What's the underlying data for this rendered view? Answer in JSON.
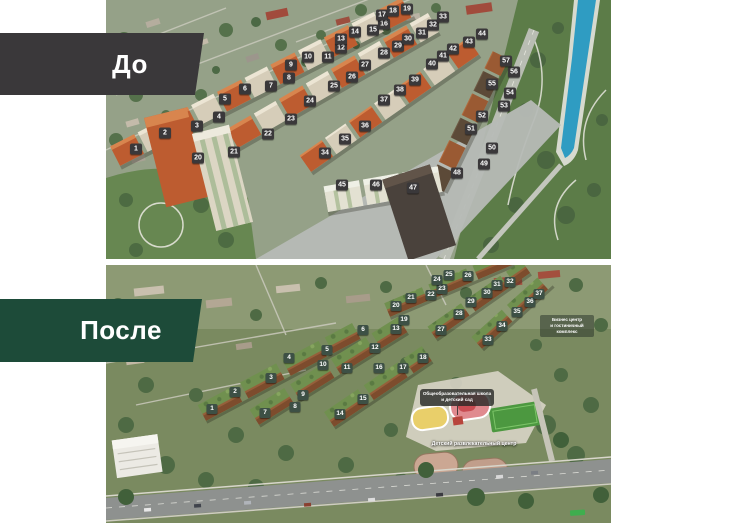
{
  "before": {
    "label": "До",
    "badges": [
      {
        "n": 1,
        "x": 30,
        "y": 149
      },
      {
        "n": 2,
        "x": 59,
        "y": 133
      },
      {
        "n": 3,
        "x": 91,
        "y": 126
      },
      {
        "n": 4,
        "x": 113,
        "y": 117
      },
      {
        "n": 5,
        "x": 119,
        "y": 99
      },
      {
        "n": 6,
        "x": 139,
        "y": 89
      },
      {
        "n": 7,
        "x": 165,
        "y": 86
      },
      {
        "n": 8,
        "x": 183,
        "y": 78
      },
      {
        "n": 9,
        "x": 185,
        "y": 65
      },
      {
        "n": 10,
        "x": 202,
        "y": 57
      },
      {
        "n": 11,
        "x": 222,
        "y": 57
      },
      {
        "n": 12,
        "x": 235,
        "y": 48
      },
      {
        "n": 13,
        "x": 235,
        "y": 39
      },
      {
        "n": 14,
        "x": 249,
        "y": 32
      },
      {
        "n": 15,
        "x": 267,
        "y": 30
      },
      {
        "n": 16,
        "x": 278,
        "y": 24
      },
      {
        "n": 17,
        "x": 276,
        "y": 15
      },
      {
        "n": 18,
        "x": 287,
        "y": 11
      },
      {
        "n": 19,
        "x": 301,
        "y": 9
      },
      {
        "n": 20,
        "x": 92,
        "y": 158
      },
      {
        "n": 21,
        "x": 128,
        "y": 152
      },
      {
        "n": 22,
        "x": 162,
        "y": 134
      },
      {
        "n": 23,
        "x": 185,
        "y": 119
      },
      {
        "n": 24,
        "x": 204,
        "y": 101
      },
      {
        "n": 25,
        "x": 228,
        "y": 86
      },
      {
        "n": 26,
        "x": 246,
        "y": 77
      },
      {
        "n": 27,
        "x": 259,
        "y": 65
      },
      {
        "n": 28,
        "x": 278,
        "y": 53
      },
      {
        "n": 29,
        "x": 292,
        "y": 46
      },
      {
        "n": 30,
        "x": 302,
        "y": 39
      },
      {
        "n": 31,
        "x": 316,
        "y": 33
      },
      {
        "n": 32,
        "x": 327,
        "y": 25
      },
      {
        "n": 33,
        "x": 337,
        "y": 17
      },
      {
        "n": 34,
        "x": 219,
        "y": 153
      },
      {
        "n": 35,
        "x": 239,
        "y": 139
      },
      {
        "n": 36,
        "x": 259,
        "y": 126
      },
      {
        "n": 37,
        "x": 278,
        "y": 100
      },
      {
        "n": 38,
        "x": 294,
        "y": 90
      },
      {
        "n": 39,
        "x": 309,
        "y": 80
      },
      {
        "n": 40,
        "x": 326,
        "y": 64
      },
      {
        "n": 41,
        "x": 337,
        "y": 56
      },
      {
        "n": 42,
        "x": 347,
        "y": 49
      },
      {
        "n": 43,
        "x": 363,
        "y": 42
      },
      {
        "n": 44,
        "x": 376,
        "y": 34
      },
      {
        "n": 45,
        "x": 236,
        "y": 185
      },
      {
        "n": 46,
        "x": 270,
        "y": 185
      },
      {
        "n": 47,
        "x": 307,
        "y": 188
      },
      {
        "n": 48,
        "x": 351,
        "y": 173
      },
      {
        "n": 49,
        "x": 378,
        "y": 164
      },
      {
        "n": 50,
        "x": 386,
        "y": 148
      },
      {
        "n": 51,
        "x": 365,
        "y": 129
      },
      {
        "n": 52,
        "x": 376,
        "y": 116
      },
      {
        "n": 53,
        "x": 398,
        "y": 106
      },
      {
        "n": 54,
        "x": 404,
        "y": 93
      },
      {
        "n": 55,
        "x": 386,
        "y": 84
      },
      {
        "n": 56,
        "x": 408,
        "y": 72
      },
      {
        "n": 57,
        "x": 400,
        "y": 61
      }
    ]
  },
  "after": {
    "label": "После",
    "badges": [
      {
        "n": 1,
        "x": 106,
        "y": 144
      },
      {
        "n": 2,
        "x": 129,
        "y": 127
      },
      {
        "n": 3,
        "x": 165,
        "y": 113
      },
      {
        "n": 4,
        "x": 183,
        "y": 93
      },
      {
        "n": 5,
        "x": 221,
        "y": 85
      },
      {
        "n": 6,
        "x": 257,
        "y": 65
      },
      {
        "n": 7,
        "x": 159,
        "y": 148
      },
      {
        "n": 8,
        "x": 189,
        "y": 142
      },
      {
        "n": 9,
        "x": 197,
        "y": 130
      },
      {
        "n": 10,
        "x": 217,
        "y": 100
      },
      {
        "n": 11,
        "x": 241,
        "y": 103
      },
      {
        "n": 12,
        "x": 269,
        "y": 83
      },
      {
        "n": 13,
        "x": 290,
        "y": 64
      },
      {
        "n": 14,
        "x": 234,
        "y": 149
      },
      {
        "n": 15,
        "x": 257,
        "y": 134
      },
      {
        "n": 16,
        "x": 273,
        "y": 103
      },
      {
        "n": 17,
        "x": 297,
        "y": 103
      },
      {
        "n": 18,
        "x": 317,
        "y": 93
      },
      {
        "n": 19,
        "x": 298,
        "y": 55
      },
      {
        "n": 20,
        "x": 290,
        "y": 41
      },
      {
        "n": 21,
        "x": 305,
        "y": 33
      },
      {
        "n": 22,
        "x": 325,
        "y": 30
      },
      {
        "n": 23,
        "x": 336,
        "y": 24
      },
      {
        "n": 24,
        "x": 331,
        "y": 15
      },
      {
        "n": 25,
        "x": 343,
        "y": 10
      },
      {
        "n": 26,
        "x": 362,
        "y": 11
      },
      {
        "n": 27,
        "x": 335,
        "y": 65
      },
      {
        "n": 28,
        "x": 353,
        "y": 49
      },
      {
        "n": 29,
        "x": 365,
        "y": 37
      },
      {
        "n": 30,
        "x": 381,
        "y": 28
      },
      {
        "n": 31,
        "x": 391,
        "y": 20
      },
      {
        "n": 32,
        "x": 404,
        "y": 17
      },
      {
        "n": 33,
        "x": 382,
        "y": 75
      },
      {
        "n": 34,
        "x": 396,
        "y": 61
      },
      {
        "n": 35,
        "x": 411,
        "y": 47
      },
      {
        "n": 36,
        "x": 424,
        "y": 37
      },
      {
        "n": 37,
        "x": 433,
        "y": 29
      }
    ],
    "annotations": {
      "business_center": [
        "Бизнес центр",
        "и гостиничный",
        "комплекс"
      ],
      "school": [
        "Общеобразовательная школа",
        "и детский сад"
      ],
      "kids_center": [
        "Детский развлекательный центр"
      ]
    }
  },
  "colors": {
    "before_banner": "#3a383a",
    "after_banner": "#1d4b39",
    "before_badge": "#3a383a",
    "after_badge": "#3d5045",
    "river": "#2f9cc2",
    "park": "#5c7c48"
  }
}
